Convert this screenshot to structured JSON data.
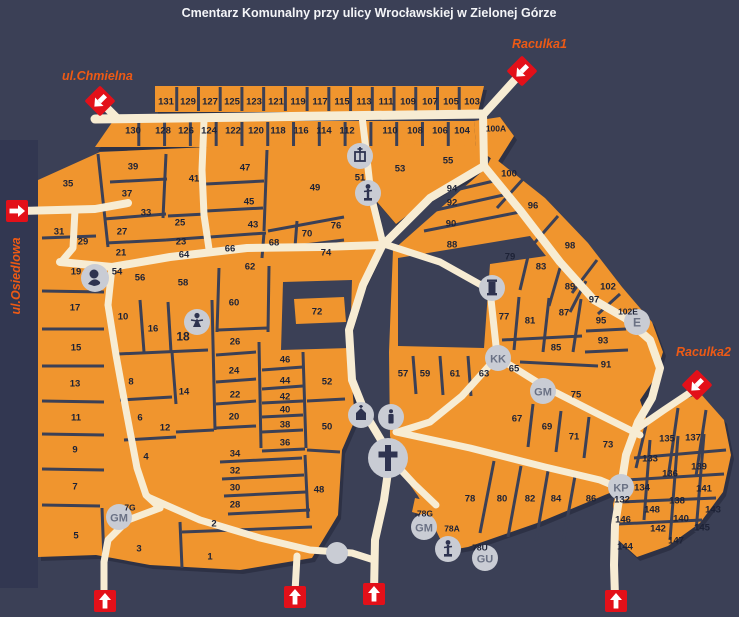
{
  "title": "Cmentarz Komunalny przy ulicy Wrocławskiej w Zielonej Górze",
  "colors": {
    "background": "#3b4056",
    "side_strip": "#323751",
    "block_orange": "#f0952e",
    "road_cream": "#f7ecd3",
    "divider": "#3b4056",
    "label": "#1d2236",
    "street_label": "#ed5a15",
    "entrance_red": "#e31019",
    "icon_circle": "#c9ccd4",
    "icon_glyph": "#2e3350",
    "badge_text": "#6a7184",
    "title_text": "#f4f5f8"
  },
  "streets": {
    "chmielna": {
      "label": "ul.Chmielna"
    },
    "osiedlowa": {
      "label": "ul.Osiedlowa"
    },
    "raculka1": {
      "label": "Raculka1"
    },
    "raculka2": {
      "label": "Raculka2"
    }
  },
  "sections": [
    {
      "n": "131",
      "x": 166,
      "y": 101
    },
    {
      "n": "129",
      "x": 188,
      "y": 101
    },
    {
      "n": "127",
      "x": 210,
      "y": 101
    },
    {
      "n": "125",
      "x": 232,
      "y": 101
    },
    {
      "n": "123",
      "x": 254,
      "y": 101
    },
    {
      "n": "121",
      "x": 276,
      "y": 101
    },
    {
      "n": "119",
      "x": 298,
      "y": 101
    },
    {
      "n": "117",
      "x": 320,
      "y": 101
    },
    {
      "n": "115",
      "x": 342,
      "y": 101
    },
    {
      "n": "113",
      "x": 364,
      "y": 101
    },
    {
      "n": "111",
      "x": 386,
      "y": 101
    },
    {
      "n": "109",
      "x": 408,
      "y": 101
    },
    {
      "n": "107",
      "x": 430,
      "y": 101
    },
    {
      "n": "105",
      "x": 451,
      "y": 101
    },
    {
      "n": "103",
      "x": 472,
      "y": 101
    },
    {
      "n": "130",
      "x": 133,
      "y": 130
    },
    {
      "n": "128",
      "x": 163,
      "y": 130
    },
    {
      "n": "126",
      "x": 186,
      "y": 130
    },
    {
      "n": "124",
      "x": 209,
      "y": 130
    },
    {
      "n": "122",
      "x": 233,
      "y": 130
    },
    {
      "n": "120",
      "x": 256,
      "y": 130
    },
    {
      "n": "118",
      "x": 278,
      "y": 130
    },
    {
      "n": "116",
      "x": 301,
      "y": 130
    },
    {
      "n": "114",
      "x": 324,
      "y": 130
    },
    {
      "n": "112",
      "x": 347,
      "y": 130
    },
    {
      "n": "110",
      "x": 390,
      "y": 130
    },
    {
      "n": "108",
      "x": 415,
      "y": 130
    },
    {
      "n": "106",
      "x": 440,
      "y": 130
    },
    {
      "n": "104",
      "x": 462,
      "y": 130
    },
    {
      "n": "100A",
      "x": 496,
      "y": 128
    },
    {
      "n": "35",
      "x": 68,
      "y": 183
    },
    {
      "n": "39",
      "x": 133,
      "y": 166
    },
    {
      "n": "37",
      "x": 127,
      "y": 193
    },
    {
      "n": "41",
      "x": 194,
      "y": 178
    },
    {
      "n": "33",
      "x": 146,
      "y": 212
    },
    {
      "n": "25",
      "x": 180,
      "y": 222
    },
    {
      "n": "31",
      "x": 59,
      "y": 231
    },
    {
      "n": "27",
      "x": 122,
      "y": 231
    },
    {
      "n": "29",
      "x": 83,
      "y": 241
    },
    {
      "n": "23",
      "x": 181,
      "y": 241
    },
    {
      "n": "21",
      "x": 121,
      "y": 252
    },
    {
      "n": "64",
      "x": 184,
      "y": 254
    },
    {
      "n": "66",
      "x": 230,
      "y": 248
    },
    {
      "n": "19",
      "x": 76,
      "y": 271
    },
    {
      "n": "54",
      "x": 117,
      "y": 271
    },
    {
      "n": "56",
      "x": 140,
      "y": 277
    },
    {
      "n": "58",
      "x": 183,
      "y": 282
    },
    {
      "n": "62",
      "x": 250,
      "y": 266
    },
    {
      "n": "60",
      "x": 234,
      "y": 302
    },
    {
      "n": "17",
      "x": 75,
      "y": 307
    },
    {
      "n": "10",
      "x": 123,
      "y": 316
    },
    {
      "n": "16",
      "x": 153,
      "y": 328
    },
    {
      "n": "18",
      "x": 183,
      "y": 337
    },
    {
      "n": "26",
      "x": 235,
      "y": 341
    },
    {
      "n": "15",
      "x": 76,
      "y": 347
    },
    {
      "n": "24",
      "x": 234,
      "y": 370
    },
    {
      "n": "13",
      "x": 75,
      "y": 383
    },
    {
      "n": "8",
      "x": 131,
      "y": 381
    },
    {
      "n": "14",
      "x": 184,
      "y": 391
    },
    {
      "n": "22",
      "x": 235,
      "y": 394
    },
    {
      "n": "11",
      "x": 76,
      "y": 417
    },
    {
      "n": "6",
      "x": 140,
      "y": 417
    },
    {
      "n": "20",
      "x": 234,
      "y": 416
    },
    {
      "n": "12",
      "x": 165,
      "y": 427
    },
    {
      "n": "9",
      "x": 75,
      "y": 449
    },
    {
      "n": "4",
      "x": 146,
      "y": 456
    },
    {
      "n": "34",
      "x": 235,
      "y": 453
    },
    {
      "n": "32",
      "x": 235,
      "y": 470
    },
    {
      "n": "30",
      "x": 235,
      "y": 487
    },
    {
      "n": "28",
      "x": 235,
      "y": 504
    },
    {
      "n": "7",
      "x": 75,
      "y": 486
    },
    {
      "n": "5",
      "x": 76,
      "y": 535
    },
    {
      "n": "3",
      "x": 139,
      "y": 548
    },
    {
      "n": "1",
      "x": 210,
      "y": 556
    },
    {
      "n": "2",
      "x": 214,
      "y": 523
    },
    {
      "n": "36",
      "x": 285,
      "y": 442
    },
    {
      "n": "38",
      "x": 285,
      "y": 424
    },
    {
      "n": "40",
      "x": 285,
      "y": 409
    },
    {
      "n": "42",
      "x": 285,
      "y": 396
    },
    {
      "n": "44",
      "x": 285,
      "y": 380
    },
    {
      "n": "46",
      "x": 285,
      "y": 359
    },
    {
      "n": "48",
      "x": 319,
      "y": 489
    },
    {
      "n": "50",
      "x": 327,
      "y": 426
    },
    {
      "n": "52",
      "x": 327,
      "y": 381
    },
    {
      "n": "72",
      "x": 317,
      "y": 311
    },
    {
      "n": "68",
      "x": 274,
      "y": 242
    },
    {
      "n": "70",
      "x": 307,
      "y": 233
    },
    {
      "n": "74",
      "x": 326,
      "y": 252
    },
    {
      "n": "76",
      "x": 336,
      "y": 225
    },
    {
      "n": "43",
      "x": 253,
      "y": 224
    },
    {
      "n": "45",
      "x": 249,
      "y": 201
    },
    {
      "n": "47",
      "x": 245,
      "y": 167
    },
    {
      "n": "49",
      "x": 315,
      "y": 187
    },
    {
      "n": "51",
      "x": 360,
      "y": 177
    },
    {
      "n": "53",
      "x": 400,
      "y": 168
    },
    {
      "n": "55",
      "x": 448,
      "y": 160
    },
    {
      "n": "94",
      "x": 452,
      "y": 188
    },
    {
      "n": "92",
      "x": 452,
      "y": 202
    },
    {
      "n": "90",
      "x": 451,
      "y": 223
    },
    {
      "n": "88",
      "x": 452,
      "y": 244
    },
    {
      "n": "100",
      "x": 509,
      "y": 173
    },
    {
      "n": "96",
      "x": 533,
      "y": 205
    },
    {
      "n": "98",
      "x": 570,
      "y": 245
    },
    {
      "n": "102",
      "x": 608,
      "y": 286
    },
    {
      "n": "97",
      "x": 594,
      "y": 299
    },
    {
      "n": "102E",
      "x": 628,
      "y": 311
    },
    {
      "n": "89",
      "x": 570,
      "y": 286
    },
    {
      "n": "83",
      "x": 541,
      "y": 266
    },
    {
      "n": "79",
      "x": 510,
      "y": 256
    },
    {
      "n": "87",
      "x": 564,
      "y": 312
    },
    {
      "n": "95",
      "x": 601,
      "y": 320
    },
    {
      "n": "93",
      "x": 603,
      "y": 340
    },
    {
      "n": "91",
      "x": 606,
      "y": 364
    },
    {
      "n": "85",
      "x": 556,
      "y": 347
    },
    {
      "n": "81",
      "x": 530,
      "y": 320
    },
    {
      "n": "77",
      "x": 504,
      "y": 316
    },
    {
      "n": "57",
      "x": 403,
      "y": 373
    },
    {
      "n": "59",
      "x": 425,
      "y": 373
    },
    {
      "n": "61",
      "x": 455,
      "y": 373
    },
    {
      "n": "63",
      "x": 484,
      "y": 373
    },
    {
      "n": "65",
      "x": 514,
      "y": 368
    },
    {
      "n": "67",
      "x": 517,
      "y": 418
    },
    {
      "n": "69",
      "x": 547,
      "y": 426
    },
    {
      "n": "71",
      "x": 574,
      "y": 436
    },
    {
      "n": "73",
      "x": 608,
      "y": 444
    },
    {
      "n": "75",
      "x": 576,
      "y": 394
    },
    {
      "n": "78",
      "x": 470,
      "y": 498
    },
    {
      "n": "80",
      "x": 502,
      "y": 498
    },
    {
      "n": "82",
      "x": 530,
      "y": 498
    },
    {
      "n": "84",
      "x": 556,
      "y": 498
    },
    {
      "n": "86",
      "x": 591,
      "y": 498
    },
    {
      "n": "132",
      "x": 622,
      "y": 499
    },
    {
      "n": "133",
      "x": 650,
      "y": 458
    },
    {
      "n": "134",
      "x": 642,
      "y": 487
    },
    {
      "n": "135",
      "x": 667,
      "y": 438
    },
    {
      "n": "136",
      "x": 670,
      "y": 473
    },
    {
      "n": "137",
      "x": 693,
      "y": 437
    },
    {
      "n": "138",
      "x": 677,
      "y": 500
    },
    {
      "n": "139",
      "x": 699,
      "y": 466
    },
    {
      "n": "140",
      "x": 681,
      "y": 518
    },
    {
      "n": "141",
      "x": 704,
      "y": 488
    },
    {
      "n": "142",
      "x": 658,
      "y": 528
    },
    {
      "n": "143",
      "x": 713,
      "y": 509
    },
    {
      "n": "144",
      "x": 625,
      "y": 546
    },
    {
      "n": "145",
      "x": 702,
      "y": 527
    },
    {
      "n": "146",
      "x": 623,
      "y": 519
    },
    {
      "n": "147",
      "x": 676,
      "y": 540
    },
    {
      "n": "148",
      "x": 652,
      "y": 509
    },
    {
      "n": "7G",
      "x": 130,
      "y": 507
    },
    {
      "n": "78G",
      "x": 425,
      "y": 513
    },
    {
      "n": "78A",
      "x": 452,
      "y": 528
    },
    {
      "n": "78U",
      "x": 480,
      "y": 547
    }
  ],
  "icons": [
    {
      "kind": "bust",
      "x": 95,
      "y": 278
    },
    {
      "kind": "angel",
      "x": 197,
      "y": 322
    },
    {
      "kind": "gate",
      "x": 360,
      "y": 156
    },
    {
      "kind": "statue",
      "x": 368,
      "y": 193
    },
    {
      "kind": "column",
      "x": 492,
      "y": 288
    },
    {
      "kind": "chapel",
      "x": 361,
      "y": 415
    },
    {
      "kind": "candle",
      "x": 391,
      "y": 417
    },
    {
      "kind": "cross",
      "x": 388,
      "y": 458
    },
    {
      "kind": "dot",
      "x": 337,
      "y": 553
    },
    {
      "kind": "badge",
      "text": "KK",
      "x": 498,
      "y": 358
    },
    {
      "kind": "badge",
      "text": "GM",
      "x": 543,
      "y": 391
    },
    {
      "kind": "badge",
      "text": "E",
      "x": 637,
      "y": 322
    },
    {
      "kind": "badge",
      "text": "KP",
      "x": 621,
      "y": 487
    },
    {
      "kind": "badge",
      "text": "GM",
      "x": 119,
      "y": 517
    },
    {
      "kind": "badge",
      "text": "GM",
      "x": 424,
      "y": 527
    },
    {
      "kind": "statue",
      "x": 448,
      "y": 549
    },
    {
      "kind": "badge",
      "text": "GU",
      "x": 485,
      "y": 558
    }
  ],
  "entrances": [
    {
      "shape": "square",
      "dir": "right",
      "x": 17,
      "y": 211
    },
    {
      "shape": "diamond",
      "dir": "down-left",
      "x": 100,
      "y": 101
    },
    {
      "shape": "diamond",
      "dir": "down-left",
      "x": 522,
      "y": 71
    },
    {
      "shape": "diamond",
      "dir": "down-left",
      "x": 697,
      "y": 385
    },
    {
      "shape": "square",
      "dir": "up",
      "x": 105,
      "y": 601
    },
    {
      "shape": "square",
      "dir": "up",
      "x": 295,
      "y": 597
    },
    {
      "shape": "square",
      "dir": "up",
      "x": 374,
      "y": 594
    },
    {
      "shape": "square",
      "dir": "up",
      "x": 616,
      "y": 601
    }
  ]
}
